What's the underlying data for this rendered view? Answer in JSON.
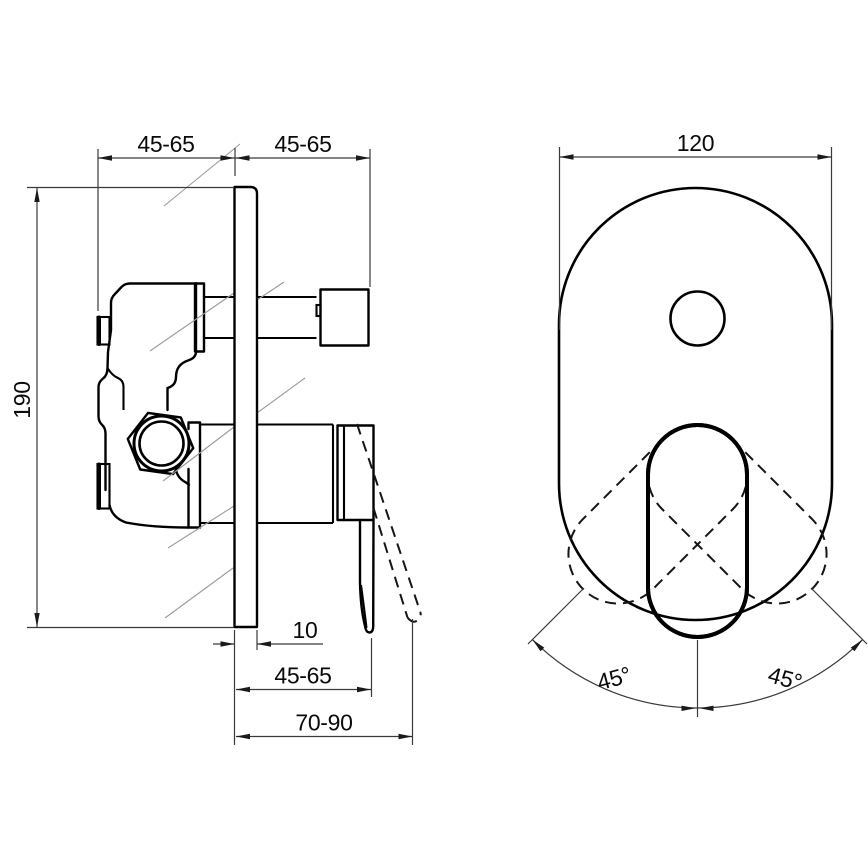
{
  "side_view": {
    "dimensions": {
      "offset_left": "45-65",
      "offset_right": "45-65",
      "body_height": "190",
      "plate_thickness": "10",
      "depth_inner": "45-65",
      "depth_total": "70-90"
    }
  },
  "front_view": {
    "dimensions": {
      "plate_width": "120",
      "swing_left": "45°",
      "swing_right": "45°"
    }
  },
  "colors": {
    "outline": "#000000",
    "dimension_lines": "#3a3a3a",
    "wall_hatch": "#9c9c9c",
    "background": "#ffffff"
  }
}
